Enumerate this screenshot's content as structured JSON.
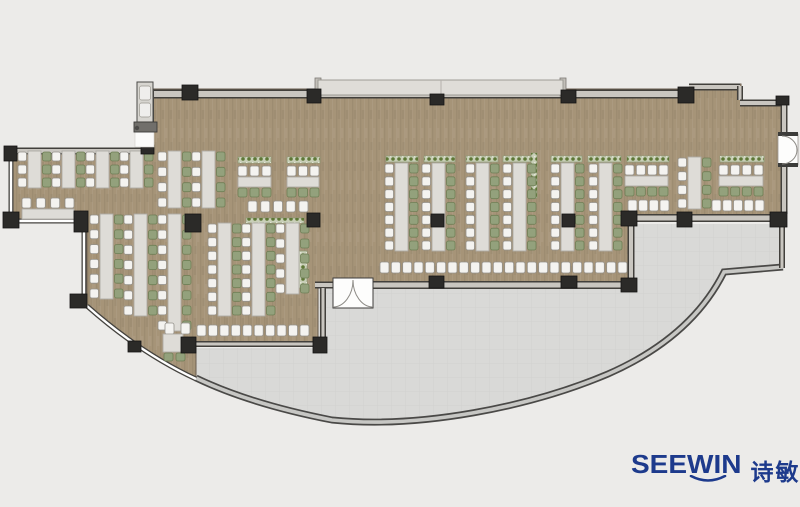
{
  "meta": {
    "title": "Office canteen floor plan rendering"
  },
  "logo": {
    "brand": "SEEWIN",
    "cn": "诗敏",
    "color": "#1d3a8c"
  },
  "colors": {
    "bg": "#ecebe9",
    "floor": "#a69478",
    "floor_edge": "#6a5e50",
    "terrace": "#d9d9d7",
    "wall_dark": "#42403c",
    "wall_band": "#c9c6c0",
    "glass_dark": "#45433f",
    "glass_light": "#ffffff",
    "rim_dark": "#4a4947",
    "rim_light": "#c7c7c4",
    "column": "#2b2a28",
    "table": "#dedcd7",
    "table_border": "#aeaba5",
    "chair_white": "#f4f3f0",
    "chair_white_border": "#94918b",
    "chair_green": "#93a17c",
    "chair_green_border": "#6f7f55",
    "planter_base": "#c9cfb8",
    "planter_dot": "#5e7736",
    "balcony": "#dfddd8",
    "door_white": "#fdfdfc"
  },
  "floor": {
    "path": "M152,89 H690 V84 H741 V101 H785 V221 H634 V286 H318 V344 H196 V379 Q140,352 87,306 V228 H80 V222 H12 V151 H152 Z"
  },
  "terrace": {
    "path": "M196,348 H316 V288 H630 V224 H782 V267 L724,272 C703,314 665,349 608,374 C530,407 420,429 332,420 Q250,404 196,378 Z",
    "rim": "M196,378 Q250,404 332,420 C420,429 530,407 608,374 C665,349 703,314 724,272 L783,267"
  },
  "balcony": {
    "x": 318,
    "y": 80,
    "w": 245,
    "h": 15,
    "seam_x": 441
  },
  "walls": [
    {
      "d": "M150,94 H690",
      "w": 9
    },
    {
      "d": "M689,87 H740",
      "w": 7
    },
    {
      "d": "M740,86 V100",
      "w": 6
    },
    {
      "d": "M740,103 H785",
      "w": 7
    },
    {
      "d": "M784,102 V135",
      "w": 7
    },
    {
      "d": "M784,164 V214",
      "w": 7
    },
    {
      "d": "M633,218 H781",
      "w": 8
    },
    {
      "d": "M631,222 V285",
      "w": 7
    },
    {
      "d": "M373,285 H633",
      "w": 8
    },
    {
      "d": "M315,285 H334",
      "w": 7
    },
    {
      "d": "M323,288 V339",
      "w": 6
    },
    {
      "d": "M196,344 H316",
      "w": 6
    },
    {
      "d": "M782,223 V268",
      "w": 6
    },
    {
      "d": "M10,151 H150",
      "w": 7
    },
    {
      "d": "M11,150 V222",
      "w": 5,
      "glass": true
    },
    {
      "d": "M11,221 H79",
      "w": 5,
      "glass": true
    },
    {
      "d": "M84,228 V304",
      "w": 5,
      "glass": true
    },
    {
      "d": "M87,306 Q140,353 196,379",
      "w": 5,
      "glass": true
    },
    {
      "d": "M152,89 V133",
      "w": 4,
      "glass": true
    }
  ],
  "columns": [
    [
      182,
      85,
      16,
      15
    ],
    [
      307,
      89,
      14,
      14
    ],
    [
      430,
      94,
      14,
      11
    ],
    [
      561,
      90,
      15,
      13
    ],
    [
      678,
      87,
      16,
      16
    ],
    [
      776,
      96,
      13,
      9
    ],
    [
      4,
      146,
      13,
      15
    ],
    [
      141,
      145,
      13,
      9
    ],
    [
      3,
      212,
      16,
      16
    ],
    [
      74,
      211,
      14,
      21
    ],
    [
      185,
      214,
      16,
      18
    ],
    [
      307,
      213,
      13,
      14
    ],
    [
      431,
      214,
      13,
      13
    ],
    [
      562,
      214,
      13,
      13
    ],
    [
      70,
      294,
      17,
      14
    ],
    [
      128,
      341,
      13,
      11
    ],
    [
      181,
      337,
      15,
      16
    ],
    [
      313,
      337,
      14,
      16
    ],
    [
      429,
      276,
      15,
      12
    ],
    [
      561,
      276,
      16,
      12
    ],
    [
      621,
      278,
      16,
      14
    ],
    [
      621,
      211,
      16,
      15
    ],
    [
      677,
      212,
      15,
      15
    ],
    [
      770,
      212,
      17,
      15
    ]
  ],
  "planters": [
    [
      386,
      156,
      32,
      6
    ],
    [
      424,
      156,
      31,
      6
    ],
    [
      466,
      156,
      32,
      6
    ],
    [
      503,
      156,
      28,
      6
    ],
    [
      551,
      156,
      31,
      6
    ],
    [
      588,
      156,
      33,
      6
    ],
    [
      627,
      156,
      42,
      6
    ],
    [
      720,
      156,
      44,
      6
    ],
    [
      238,
      157,
      33,
      6
    ],
    [
      287,
      157,
      33,
      6
    ],
    [
      246,
      218,
      58,
      5
    ],
    [
      531,
      153,
      6,
      45
    ],
    [
      298,
      251,
      9,
      37
    ],
    [
      101,
      217,
      7,
      24
    ]
  ],
  "desk_columns": [
    [
      28,
      151,
      188,
      3
    ],
    [
      62,
      151,
      188,
      3
    ],
    [
      96,
      151,
      188,
      3
    ],
    [
      130,
      151,
      188,
      3
    ],
    [
      168,
      151,
      208,
      4
    ],
    [
      202,
      151,
      208,
      4
    ],
    [
      218,
      223,
      316,
      7
    ],
    [
      252,
      223,
      316,
      7
    ],
    [
      286,
      223,
      294,
      5
    ],
    [
      100,
      214,
      299,
      6
    ],
    [
      134,
      214,
      316,
      7
    ],
    [
      168,
      214,
      331,
      8
    ],
    [
      395,
      163,
      251,
      7
    ],
    [
      432,
      163,
      251,
      7
    ],
    [
      476,
      163,
      251,
      7
    ],
    [
      513,
      163,
      251,
      7
    ],
    [
      561,
      163,
      251,
      7
    ],
    [
      599,
      163,
      251,
      7
    ],
    [
      688,
      157,
      209,
      4
    ]
  ],
  "desk_rows": [
    [
      238,
      271,
      177,
      3,
      3
    ],
    [
      287,
      319,
      177,
      3,
      3
    ],
    [
      625,
      668,
      176,
      4,
      4
    ],
    [
      719,
      763,
      176,
      4,
      4
    ],
    [
      22,
      74,
      209,
      4,
      0
    ]
  ],
  "chair_rows": [
    [
      380,
      627,
      262,
      22
    ],
    [
      197,
      309,
      325,
      10
    ],
    [
      628,
      669,
      200,
      4
    ],
    [
      712,
      764,
      200,
      5
    ],
    [
      248,
      308,
      201,
      5
    ],
    [
      165,
      190,
      323,
      2
    ]
  ],
  "misc_tables": [
    [
      163,
      334,
      20,
      18
    ]
  ],
  "misc_green_chairs": [
    [
      164,
      353
    ],
    [
      176,
      353
    ]
  ],
  "doors": {
    "bottom_double": {
      "box": [
        333,
        278,
        40,
        30
      ],
      "arc_left": "M333,307 A20,27 0 0 0 353,280",
      "arc_right": "M373,307 A20,27 0 0 1 353,280"
    },
    "right_single": {
      "box": [
        778,
        134,
        20,
        31
      ],
      "cap_top": [
        778,
        132,
        20,
        4
      ],
      "cap_bottom": [
        778,
        163,
        20,
        4
      ],
      "arc_top": "M782,136 A15,14 0 0 1 797,150",
      "arc_bottom": "M782,164 A15,14 0 0 0 797,150"
    },
    "top_left_gap": [
      135,
      132,
      19,
      15
    ]
  },
  "panel": {
    "body": [
      137,
      82,
      16,
      40
    ],
    "slots": [
      [
        139.5,
        86,
        11,
        14
      ],
      [
        139.5,
        103,
        11,
        14
      ]
    ],
    "bar": [
      134,
      122,
      23,
      10
    ],
    "knob": [
      137,
      128
    ],
    "gap": [
      135,
      132,
      19,
      15
    ]
  }
}
